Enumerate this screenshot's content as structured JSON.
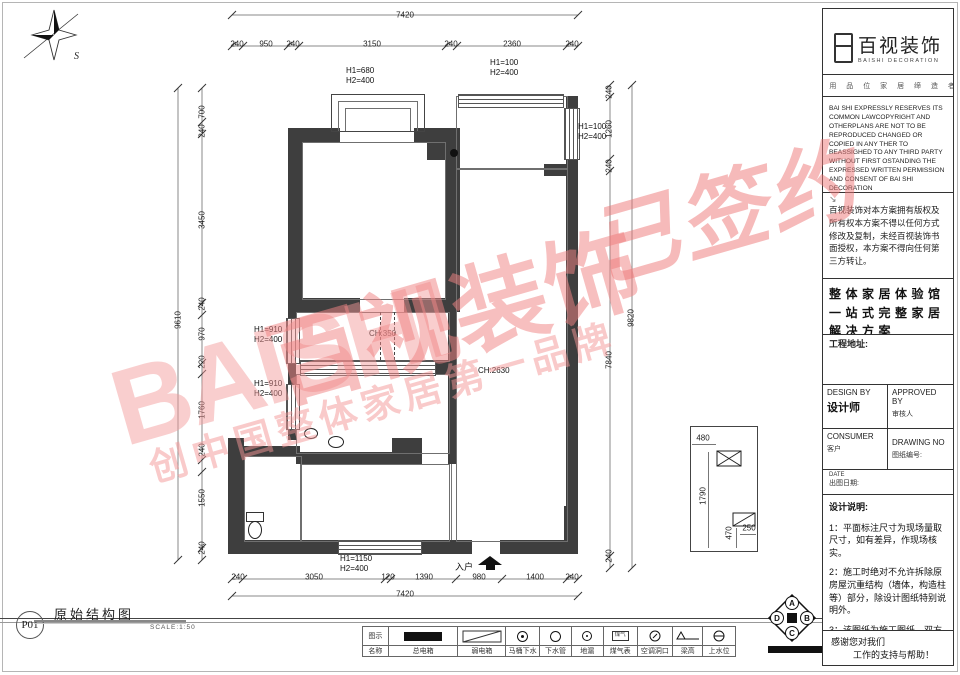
{
  "watermark": {
    "en": "BAISHI",
    "cn": "百视装饰",
    "stamp": "已签约",
    "tagline": "创中国整体家居第一品牌"
  },
  "compass": {
    "label": "S"
  },
  "plan": {
    "dims": {
      "top_total": "7420",
      "top": [
        "240",
        "950",
        "240",
        "3150",
        "240",
        "2360",
        "240"
      ],
      "bottom_total": "7420",
      "bottom": [
        "240",
        "3050",
        "120",
        "1390",
        "980",
        "1400",
        "240"
      ],
      "left_total": "9610",
      "left": [
        "700",
        "240",
        "3450",
        "240",
        "970",
        "220",
        "1760",
        "240",
        "1550",
        "240"
      ],
      "right_total": "9820",
      "right": [
        "240",
        "1260",
        "240",
        "7840",
        "240"
      ]
    },
    "labels": {
      "top_bay": "H1=680\nH2=400",
      "balcony": "H1=100\nH2=400",
      "right_window": "H1=100\nH2=400",
      "mid_left_upper": "H1=910\nH2=400",
      "mid_left_lower": "H1=910\nH2=400",
      "beam": "CH:350",
      "ceiling": "CH:2630",
      "bottom_window": "H1=1150\nH2=400",
      "entry": "入户"
    },
    "detail": {
      "d1": "480",
      "d2": "1790",
      "d3": "470",
      "d4": "250"
    }
  },
  "footer": {
    "code": "P01",
    "title": "原始结构图",
    "scale": "SCALE:1:50"
  },
  "legend": {
    "header_top": "图示",
    "header_bottom": "名称",
    "items": [
      {
        "label": "总电箱"
      },
      {
        "label": "弱电箱"
      },
      {
        "label": "马桶下水"
      },
      {
        "label": "下水管"
      },
      {
        "label": "地漏"
      },
      {
        "label": "煤气表",
        "symbol_text": "煤气"
      },
      {
        "label": "空调洞口"
      },
      {
        "label": "梁高"
      },
      {
        "label": "上水位"
      }
    ]
  },
  "corner_logo": {
    "top": "A",
    "right": "B",
    "bottom": "C",
    "left": "D"
  },
  "panel": {
    "logo_cn": "百视装饰",
    "logo_en": "BAISHI DECORATION",
    "slogan": "· 用 品 位 家 居 缔 造 者",
    "copyright_en": "BAI SHI EXPRESSLY RESERVES ITS COMMON LAWCOPYRIGHT AND OTHERPLANS ARE NOT TO BE REPRODUCED CHANGED OR COPIED IN ANY THER TO BEASSIGHED TO ANY THIRD PARTY WITHOUT FIRST OSTANDING THE EXPRESSED WRITTEN PERMISSION AND CONSENT OF BAI SHI DECORATION",
    "arrow": "↘",
    "copyright_cn": "百视装饰对本方案拥有版权及所有权本方案不得以任何方式修改及复制，未经百视装饰书面授权，本方案不得向任何第三方转让。",
    "heading": "整体家居体验馆一站式完整家居解决方案",
    "address_label": "工程地址:",
    "design_by_en": "DESIGN BY",
    "design_by_cn": "设计师",
    "approved_en": "APPROVED BY",
    "approved_cn": "审核人",
    "consumer_en": "CONSUMER",
    "consumer_cn": "客户",
    "drawing_en": "DRAWING NO",
    "drawing_cn": "图纸编号:",
    "date_en": "DATE",
    "date_cn": "出图日期:",
    "notes_title": "设计说明:",
    "notes": [
      "1：平面标注尺寸为现场量取尺寸，如有差异，作现场核实。",
      "2：施工时绝对不允许拆除原房屋沉重结构（墙体，构造柱等）部分，除设计图纸特别说明外。",
      "3：该图纸为施工图纸，双方（设计和甲方）签字认可后，方可作为施工依据。"
    ],
    "thanks1": "感谢您对我们",
    "thanks2": "工作的支持与帮助！"
  }
}
